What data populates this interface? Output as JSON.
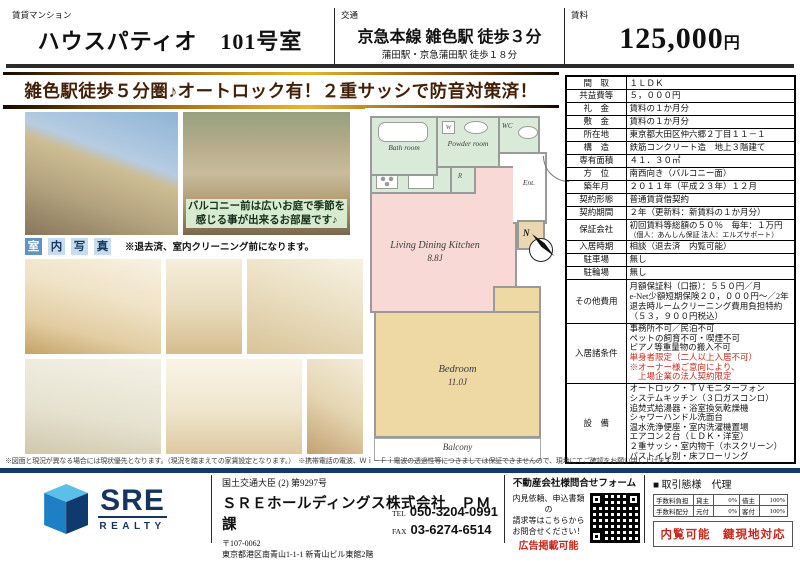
{
  "header": {
    "category": "賃貸マンション",
    "title": "ハウスパティオ　101号室",
    "access_label": "交通",
    "access_main": "京急本線 雑色駅 徒歩３分",
    "access_sub": "蒲田駅・京急蒲田駅 徒歩１８分",
    "rent_label": "賃料",
    "rent_value": "125,000",
    "rent_unit": "円",
    "catch_copy": "雑色駅徒歩５分圏♪オートロック有！２重サッシで防音対策済！"
  },
  "photos": {
    "garden_caption_line1": "バルコニー前は広いお庭で季節を",
    "garden_caption_line2": "感じる事が出来るお部屋です♪",
    "interior_label_chars": [
      "室",
      "内",
      "写",
      "真"
    ],
    "interior_note": "※退去済、室内クリーニング前になります。"
  },
  "floorplan": {
    "bath_label": "Bath room",
    "powder_label": "Powder room",
    "wc_label": "WC",
    "ent_label": "Ent.",
    "washer_label": "W",
    "fridge_label": "R",
    "ldk_name": "Living Dining Kitchen",
    "ldk_size": "8.8J",
    "bedroom_name": "Bedroom",
    "bedroom_size": "11.0J",
    "balcony_label": "Balcony",
    "north_label": "N"
  },
  "details": {
    "rows": [
      {
        "label": "間　取",
        "value": "１ＬＤＫ"
      },
      {
        "label": "共益費等",
        "value": "５，０００円"
      },
      {
        "label": "礼　金",
        "value": "賃料の１か月分"
      },
      {
        "label": "敷　金",
        "value": "賃料の１か月分"
      },
      {
        "label": "所在地",
        "value": "東京都大田区仲六郷２丁目１１－１"
      },
      {
        "label": "構　造",
        "value": "鉄筋コンクリート造　地上３階建て"
      },
      {
        "label": "専有面積",
        "value": "４１．３０㎡"
      },
      {
        "label": "方　位",
        "value": "南西向き（バルコニー面）"
      },
      {
        "label": "築年月",
        "value": "２０１１年（平成２３年）１２月"
      },
      {
        "label": "契約形態",
        "value": "普通賃貸借契約"
      },
      {
        "label": "契約期間",
        "value": "２年（更新料：新賃料の１か月分）"
      }
    ],
    "guarantor": {
      "label": "保証会社",
      "line1": "初回賃料等総額の５０％　毎年：１万円",
      "line2": "（個人：あんしん保証 法人：エルズサポート）"
    },
    "move_in": {
      "label": "入居時期",
      "value": "相談（退去済　内覧可能）"
    },
    "parking": {
      "label": "駐車場",
      "value": "無し"
    },
    "bicycle": {
      "label": "駐輪場",
      "value": "無し"
    },
    "other_costs": {
      "label": "その他費用",
      "lines": [
        "月額保証料（口振）：５５０円／月",
        "e-Net少額短期保険２０，０００円～／2年",
        "退去時ルームクリーニング費用負担特約",
        "（５３，９００円税込）"
      ]
    },
    "conditions": {
      "label": "入居諸条件",
      "black": [
        "事務所不可／民泊不可",
        "ペットの飼育不可・喫煙不可",
        "ピアノ等重量物の搬入不可"
      ],
      "red": [
        "単身者限定（二人以上入居不可）",
        "※オーナー様ご意向により、",
        "　上場企業の法人契約限定"
      ]
    },
    "equipment": {
      "label": "設　備",
      "lines": [
        "オートロック・ＴＶモニターフォン",
        "システムキッチン（３口ガスコンロ）",
        "追焚式給湯器・浴室換気乾燥機",
        "シャワーハンドル洗面台",
        "温水洗浄便座・室内洗濯機置場",
        "エアコン２台（ＬＤＫ・洋室）",
        "２重サッシ・室内物干（ホスクリーン）",
        "バストイレ別・床フローリング"
      ]
    }
  },
  "disclaimer": "※図面と現況が異なる場合には現状優先となります。（現況を踏まえての家賃設定となります。）　※携帯電話の電波、Ｗｉ－Ｆｉ電波の透過性等につきましては保証できませんので、現地にてご確認をお願い申し上げます。",
  "footer": {
    "logo_text": "SRE",
    "logo_sub": "REALTY",
    "license": "国土交通大臣 (2) 第9297号",
    "company": "ＳＲＥホールディングス株式会社　ＰＭ課",
    "postal": "〒107-0062",
    "address": "東京都港区南青山1-1-1 新青山ビル東館2階",
    "tel_label": "TEL",
    "tel": "050-3204-0991",
    "fax_label": "FAX",
    "fax": "03-6274-6514",
    "form_title": "不動産会社様問合せフォーム",
    "form_lines": [
      "内見依頼、申込書類の",
      "請求等はこちらから",
      "お問合せください！"
    ],
    "ad_note": "広告掲載可能",
    "deal_title": "■ 取引態様　代理",
    "fee_rows": [
      [
        "手数料負担",
        "貸主",
        "0%",
        "借主",
        "100%"
      ],
      [
        "手数料配分",
        "元付",
        "0%",
        "客付",
        "100%"
      ]
    ],
    "status_note": "内覧可能　鍵現地対応"
  },
  "colors": {
    "accent_navy": "#17386b",
    "accent_gold": "#d49c1e",
    "alert_red": "#c9281e",
    "room_green": "#d9ead9",
    "room_pink": "#f9d9d5",
    "room_tan": "#eed9a4"
  }
}
